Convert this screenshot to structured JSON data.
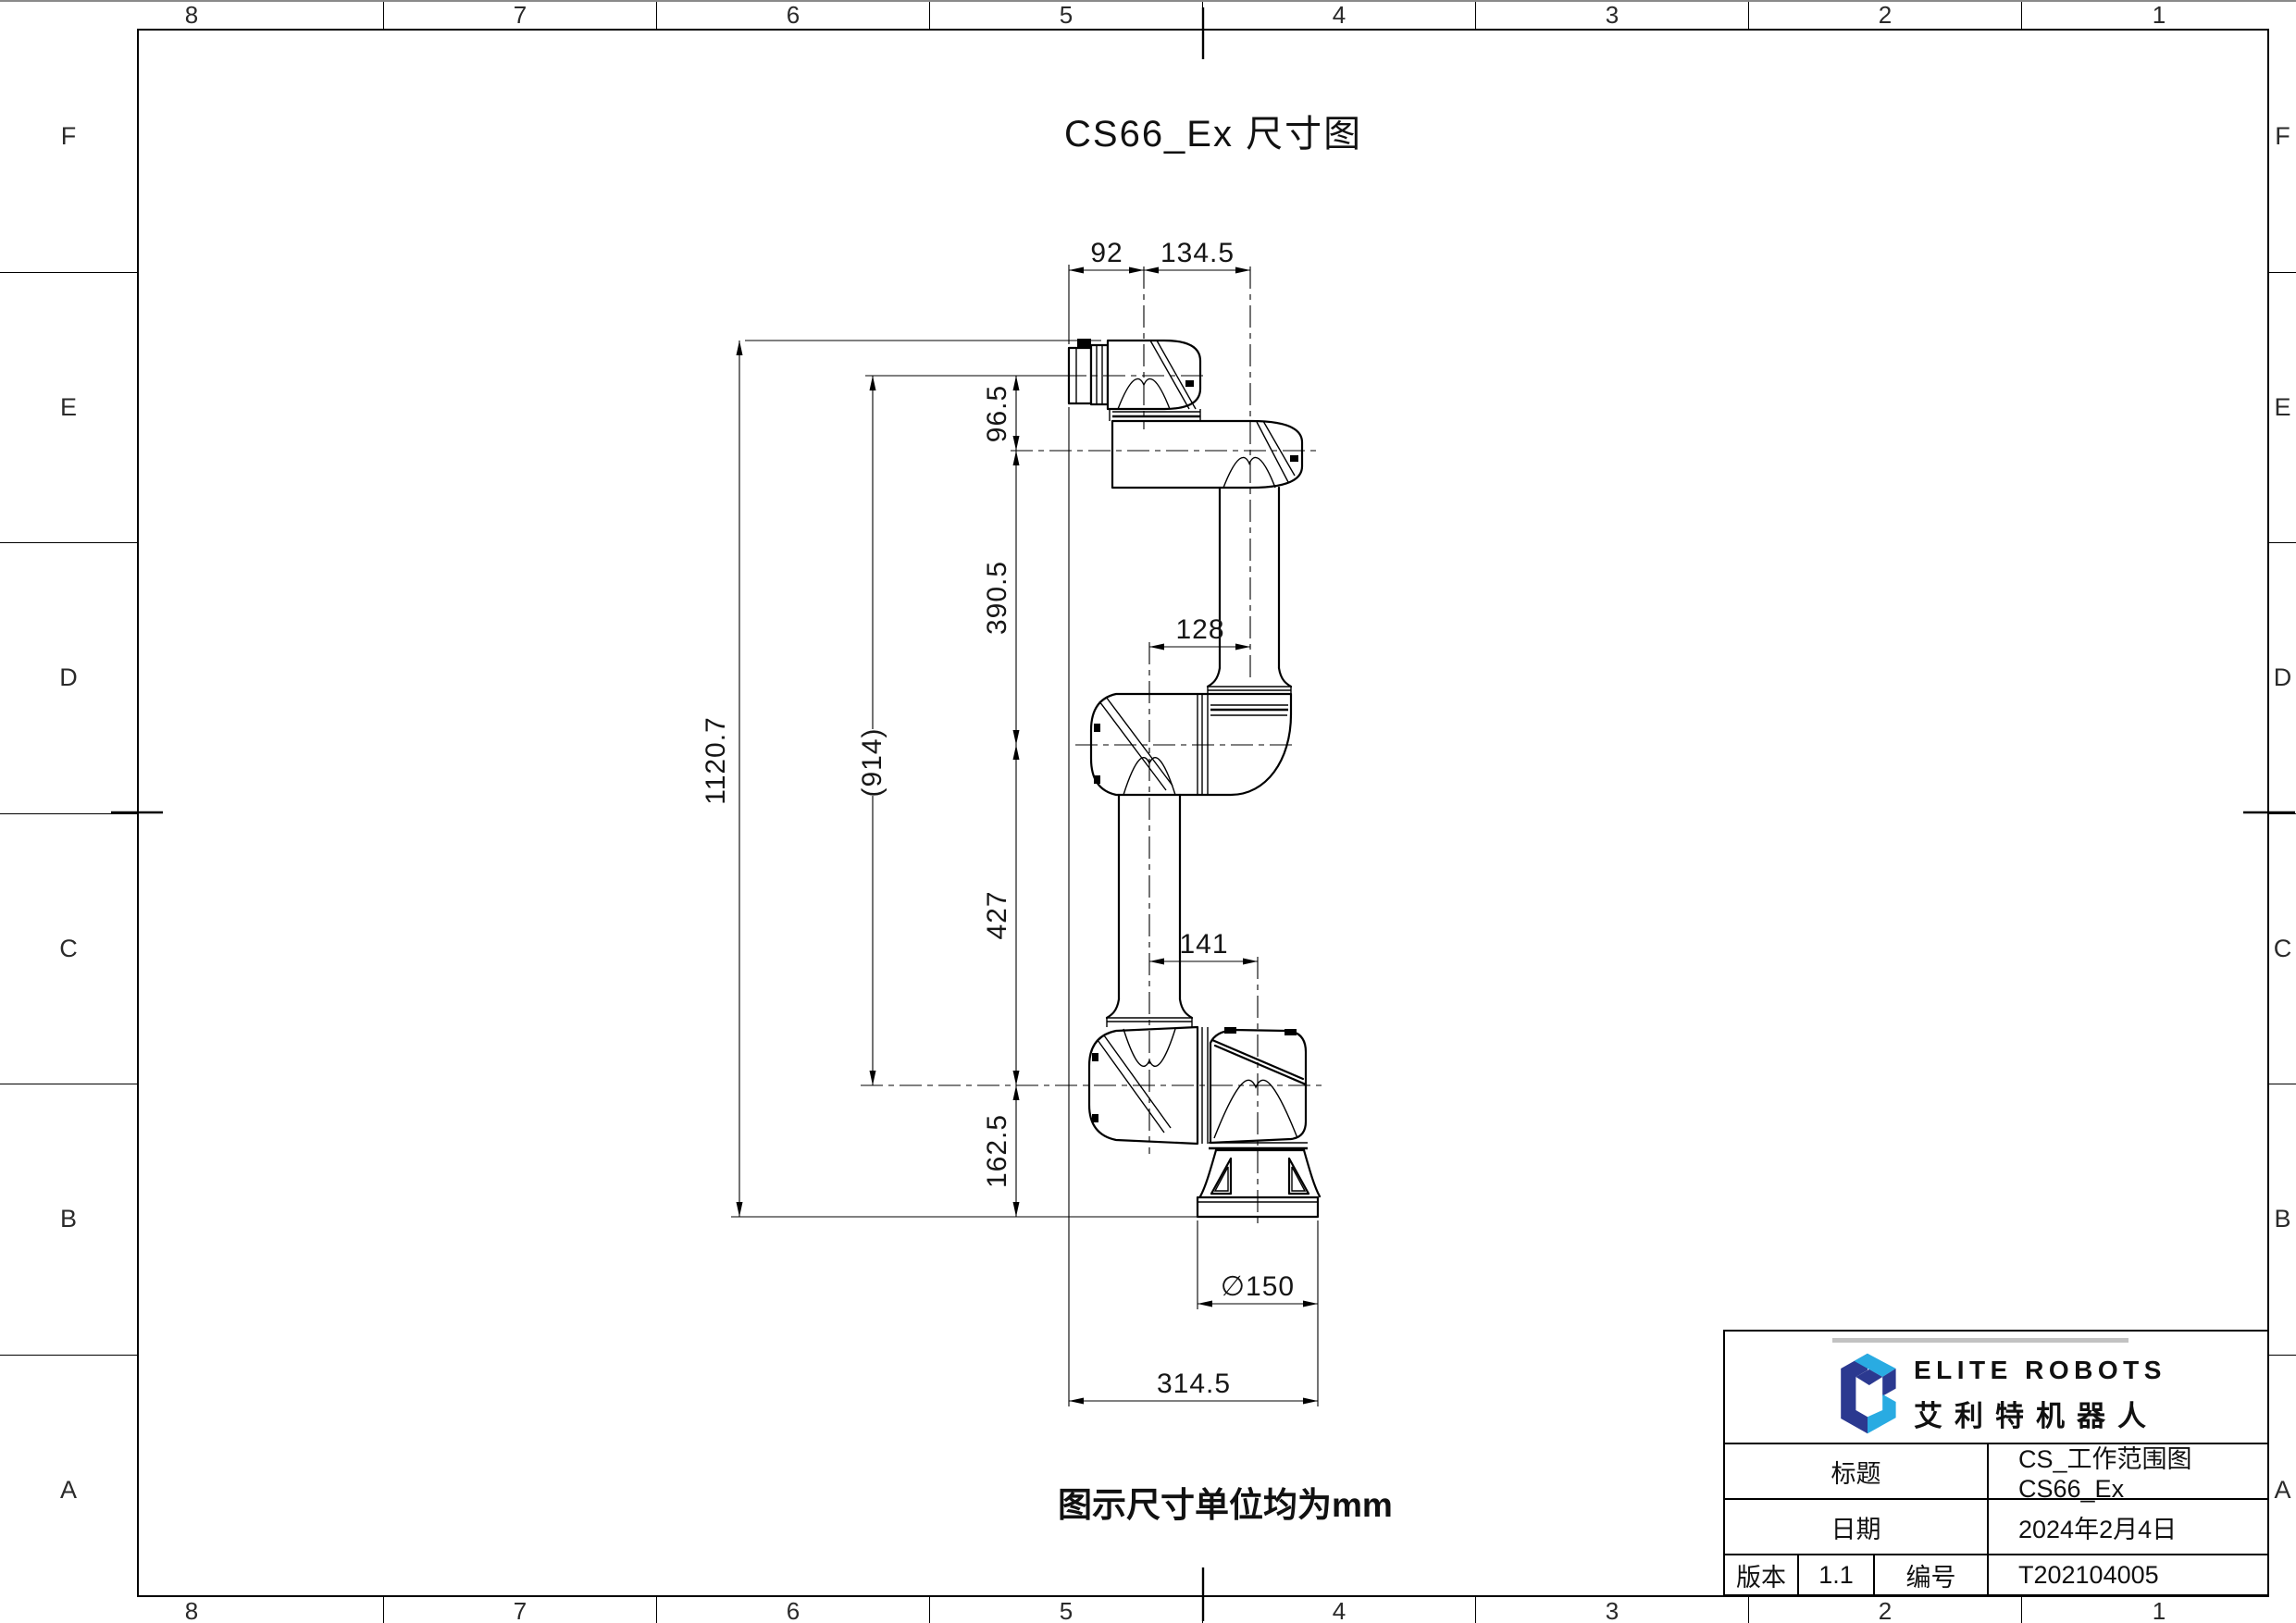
{
  "sheet": {
    "zone_columns": [
      "8",
      "7",
      "6",
      "5",
      "4",
      "3",
      "2",
      "1"
    ],
    "zone_rows": [
      "F",
      "E",
      "D",
      "C",
      "B",
      "A"
    ]
  },
  "drawing": {
    "title": "CS66_Ex 尺寸图",
    "note": "图示尺寸单位均为mm"
  },
  "dims": {
    "d92": "92",
    "d134_5": "134.5",
    "d96_5": "96.5",
    "d390_5": "390.5",
    "d1120_7": "1120.7",
    "d914": "(914)",
    "d128": "128",
    "d427": "427",
    "d141": "141",
    "d162_5": "162.5",
    "d150": "∅150",
    "d314_5": "314.5"
  },
  "title_block": {
    "brand_en": "ELITE ROBOTS",
    "brand_cn": "艾利特机器人",
    "logo_colors": {
      "dark": "#2B3990",
      "light": "#29ABE2"
    },
    "title_label": "标题",
    "title_value": "CS_工作范围图 CS66_Ex",
    "date_label": "日期",
    "date_value": "2024年2月4日",
    "version_label": "版本",
    "version_value": "1.1",
    "number_label": "编号",
    "number_value": "T202104005"
  }
}
